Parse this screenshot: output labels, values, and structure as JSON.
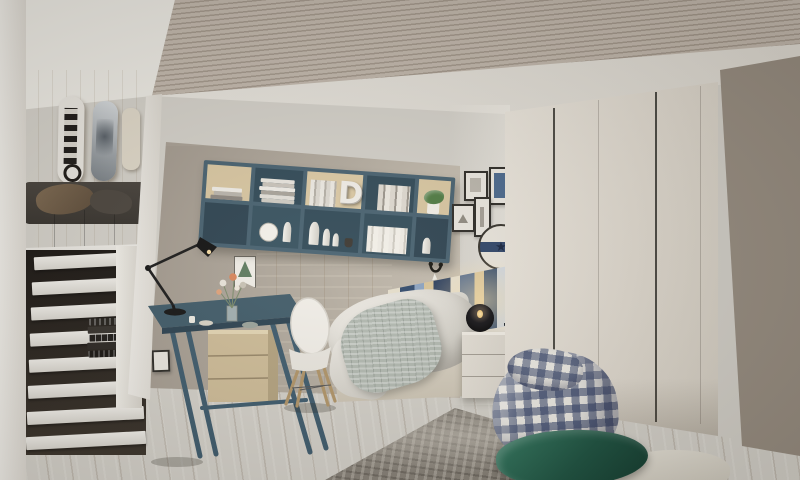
{
  "scene": {
    "description": "3D interior render of a modern teen bedroom with loft lounge, staircase, desk nook, bed and wardrobe",
    "style": "architectural visualization photo"
  },
  "palette": {
    "wall": "#d3d0c9",
    "mosaic_wallpaper": "#a89f94",
    "wood_panel": "#d9c7a2",
    "slate_blue_furniture": "#3f5a68",
    "floor_wood": "#c7bcab",
    "wardrobe_cream": "#e2dcd2",
    "bedding_white": "#e9e6df",
    "bean_bag_navy": "#31436b",
    "cushion_green": "#226049",
    "rug_grey": "#837d75",
    "stair_tread": "#e9e6e0",
    "stair_riser": "#2e2822",
    "sofa_dark": "#3b3733"
  },
  "objects": {
    "loft": {
      "label": "loft lounge with dark sofa and brown pillow",
      "skateboard_count": 3
    },
    "skateboards": {
      "labels": [
        "black-and-white graphic deck",
        "grey artwork deck",
        "cream deck (partial)"
      ]
    },
    "stairs": {
      "label": "white staircase with dark risers",
      "steps": 8,
      "books_on_step": "stack of dark books"
    },
    "shelf": {
      "label": "wall-mounted slate-blue shelving with books and decor",
      "decor_letter": "D",
      "compartments": 10
    },
    "desk": {
      "label": "slate-blue trestle desk with wood drawer unit"
    },
    "desk_lamp": {
      "label": "black articulated desk lamp"
    },
    "chair": {
      "label": "white shell chair with wooden legs"
    },
    "pennant": {
      "label": "small pennant banner with green triangle"
    },
    "bed": {
      "label": "upholstered bed with white duvet and grey knit throw",
      "headboard": "striped blue/cream/wood panel"
    },
    "nightstand": {
      "label": "white drawer nightstand with black bowl lamp and sailboat model"
    },
    "frames": {
      "count": 4,
      "label": "gallery of black picture frames, one with blue art"
    },
    "wall_clock": {
      "label": "round clock with navy band",
      "star_glyph": "★"
    },
    "wardrobe": {
      "label": "cream wardrobe with four doors and dark groove handles",
      "doors": 4
    },
    "bean_bag": {
      "label": "blue-white gingham bean bag pouf"
    },
    "cushions": {
      "labels": [
        "dark green velvet cushion",
        "light grey cushion"
      ]
    },
    "rug": {
      "label": "mottled grey area rug"
    },
    "ceiling": {
      "label": "slatted wood ceiling panel with white cove"
    }
  }
}
